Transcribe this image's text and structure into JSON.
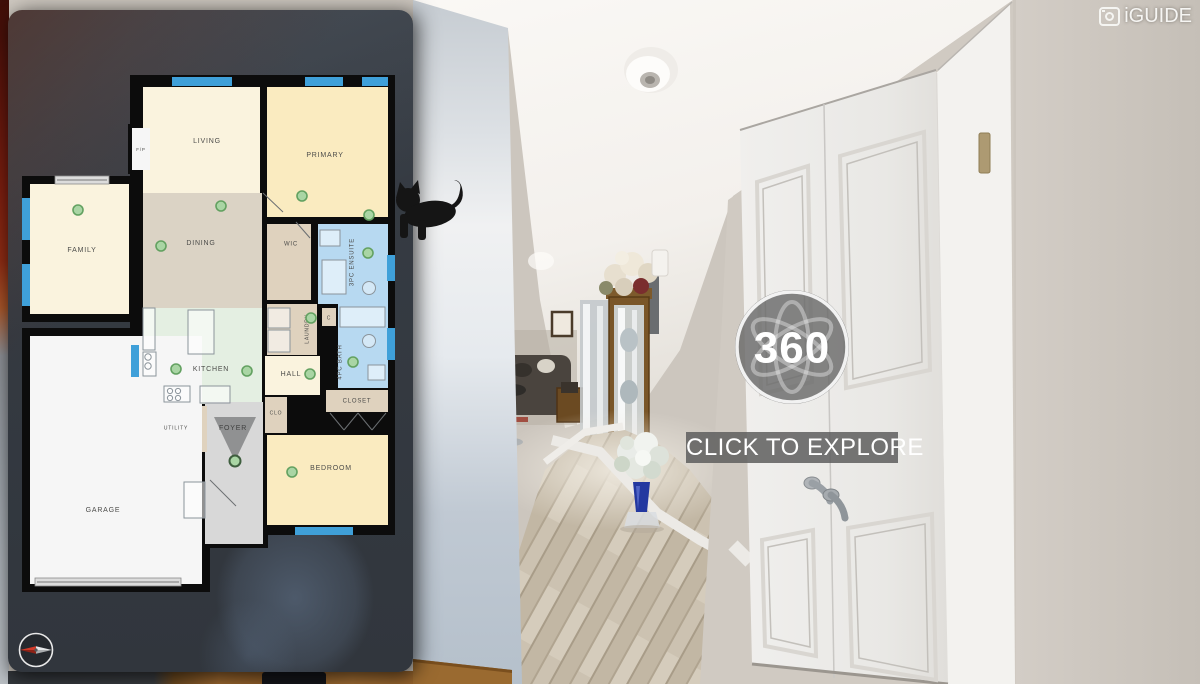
{
  "branding": {
    "logo": "iGUIDE",
    "logo_icon": "camera-square-icon"
  },
  "overlay": {
    "badge": "360",
    "badge_icon": "atom-orbits-icon",
    "cta": "CLICK TO EXPLORE",
    "compass_icon": "compass-needle-icon",
    "cta_bg": "#5C5C5C",
    "badge_ring": "#F8F8F8"
  },
  "floorplan": {
    "wall_color": "#0C0C0C",
    "colors": {
      "cream": "#FAF3DE",
      "yellow": "#FAEBC0",
      "beige": "#DBD3C5",
      "tan": "#DFD2BE",
      "mint": "#E4EFE2",
      "blue": "#B7D9F1",
      "gray": "#D8D8D8",
      "white": "#F6F6F6",
      "window": "#3FA0D9",
      "dot_fill": "#A9D5A4",
      "dot_stroke": "#63A161",
      "label": "#4C4C4A",
      "slider_fill": "#DCDCDC",
      "slider_stroke": "#8A8A8A",
      "fixture_stroke": "#8B949B"
    },
    "blocks": [
      [
        130,
        75,
        265,
        460
      ],
      [
        22,
        176,
        115,
        146
      ],
      [
        22,
        328,
        188,
        264
      ],
      [
        128,
        124,
        26,
        50
      ],
      [
        200,
        402,
        68,
        146
      ]
    ],
    "rooms": [
      {
        "label": "LIVING",
        "rect": [
          143,
          87,
          117,
          106
        ],
        "color": "cream",
        "lpos": [
          207,
          141
        ],
        "fs": 7
      },
      {
        "label": "PRIMARY",
        "rect": [
          267,
          87,
          121,
          130
        ],
        "color": "yellow",
        "lpos": [
          325,
          155
        ],
        "fs": 7
      },
      {
        "label": "DINING",
        "rect": [
          143,
          193,
          119,
          115
        ],
        "color": "beige",
        "lpos": [
          201,
          243
        ],
        "fs": 7
      },
      {
        "label": "FAMILY",
        "rect": [
          30,
          184,
          99,
          130
        ],
        "color": "cream",
        "lpos": [
          82,
          250
        ],
        "fs": 7
      },
      {
        "label": "WIC",
        "rect": [
          267,
          224,
          44,
          76
        ],
        "color": "tan",
        "lpos": [
          291,
          244
        ],
        "fs": 6
      },
      {
        "label": "3PC ENSUITE",
        "rect": [
          318,
          224,
          70,
          80
        ],
        "color": "blue",
        "lpos": [
          352,
          262
        ],
        "fs": 6,
        "rot": -90
      },
      {
        "label": "KITCHEN",
        "rect": [
          143,
          308,
          119,
          96
        ],
        "color": "mint",
        "lpos": [
          211,
          369
        ],
        "fs": 7
      },
      {
        "label": "LAUNDRY",
        "rect": [
          267,
          304,
          50,
          51
        ],
        "color": "tan",
        "lpos": [
          307,
          329
        ],
        "fs": 5,
        "rot": -90
      },
      {
        "label": "C",
        "rect": [
          322,
          308,
          14,
          18
        ],
        "color": "tan",
        "lpos": [
          329,
          318
        ],
        "fs": 5
      },
      {
        "label": "4PC BATH",
        "rect": [
          338,
          304,
          50,
          84
        ],
        "color": "blue",
        "lpos": [
          340,
          362
        ],
        "fs": 6,
        "rot": -90
      },
      {
        "label": "HALL",
        "rect": [
          265,
          356,
          55,
          39
        ],
        "color": "cream",
        "lpos": [
          291,
          374
        ],
        "fs": 7
      },
      {
        "label": "CLOSET",
        "rect": [
          326,
          390,
          62,
          22
        ],
        "color": "tan",
        "lpos": [
          357,
          401
        ],
        "fs": 6
      },
      {
        "label": "CLO",
        "rect": [
          265,
          397,
          22,
          36
        ],
        "color": "tan",
        "lpos": [
          276,
          413
        ],
        "fs": 5
      },
      {
        "label": "FOYER",
        "rect": [
          205,
          402,
          58,
          142
        ],
        "color": "gray",
        "lpos": [
          233,
          428
        ],
        "fs": 7
      },
      {
        "label": "UTILITY",
        "rect": [
          150,
          406,
          57,
          46
        ],
        "color": "tan",
        "lpos": [
          176,
          428
        ],
        "fs": 5
      },
      {
        "label": "GARAGE",
        "rect": [
          30,
          336,
          172,
          248
        ],
        "color": "white",
        "lpos": [
          103,
          510
        ],
        "fs": 7
      },
      {
        "label": "BEDROOM",
        "rect": [
          267,
          435,
          121,
          90
        ],
        "color": "yellow",
        "lpos": [
          331,
          468
        ],
        "fs": 7
      },
      {
        "label": "F/P",
        "rect": [
          132,
          128,
          18,
          42
        ],
        "color": "white",
        "lpos": [
          141,
          150
        ],
        "fs": 4.5
      }
    ],
    "windows": [
      [
        172,
        77,
        60,
        9
      ],
      [
        305,
        77,
        38,
        9
      ],
      [
        362,
        77,
        26,
        9
      ],
      [
        22,
        198,
        8,
        42
      ],
      [
        22,
        264,
        8,
        42
      ],
      [
        131,
        345,
        8,
        32
      ],
      [
        387,
        255,
        8,
        26
      ],
      [
        387,
        328,
        8,
        32
      ],
      [
        295,
        527,
        58,
        8
      ]
    ],
    "sliders": [
      [
        55,
        176,
        54,
        8
      ],
      [
        35,
        578,
        146,
        8
      ]
    ],
    "fixtures": {
      "rects": [
        [
          188,
          310,
          26,
          44
        ],
        [
          143,
          308,
          12,
          42
        ],
        [
          143,
          352,
          13,
          24
        ],
        [
          164,
          386,
          26,
          16
        ],
        [
          200,
          386,
          30,
          17
        ],
        [
          322,
          260,
          24,
          34
        ],
        [
          320,
          230,
          20,
          16
        ],
        [
          340,
          307,
          45,
          20
        ],
        [
          268,
          308,
          22,
          20
        ],
        [
          268,
          330,
          22,
          22
        ],
        [
          368,
          365,
          17,
          15
        ],
        [
          184,
          482,
          21,
          36
        ]
      ],
      "circles": [
        [
          170,
          391,
          2.6
        ],
        [
          178,
          391,
          2.6
        ],
        [
          170,
          398,
          2.6
        ],
        [
          178,
          398,
          2.6
        ],
        [
          148,
          357,
          3.2
        ],
        [
          148,
          366,
          3.2
        ],
        [
          369,
          288,
          6.5
        ],
        [
          369,
          341,
          6.5
        ]
      ],
      "lines": [
        [
          263,
          193,
          283,
          212
        ],
        [
          296,
          222,
          310,
          238
        ],
        [
          330,
          413,
          344,
          430
        ],
        [
          344,
          430,
          358,
          413
        ],
        [
          358,
          413,
          372,
          430
        ],
        [
          372,
          430,
          386,
          413
        ],
        [
          210,
          480,
          236,
          506
        ]
      ]
    },
    "dots": [
      [
        78,
        210
      ],
      [
        221,
        206
      ],
      [
        161,
        246
      ],
      [
        302,
        196
      ],
      [
        369,
        215
      ],
      [
        368,
        253
      ],
      [
        176,
        369
      ],
      [
        247,
        371
      ],
      [
        310,
        374
      ],
      [
        311,
        318
      ],
      [
        353,
        362
      ],
      [
        292,
        472
      ]
    ],
    "current_dot": [
      235,
      461
    ]
  }
}
